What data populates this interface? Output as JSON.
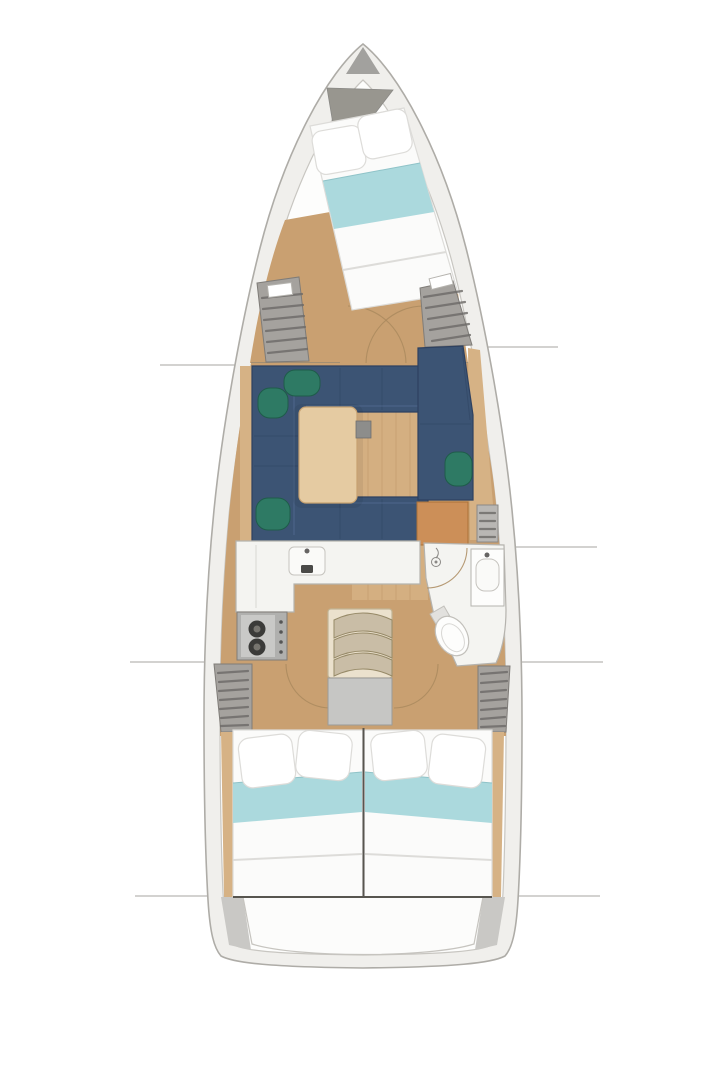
{
  "figure": {
    "type": "yacht-interior-floor-plan",
    "orientation": "bow-up",
    "description": "Top-down interior layout plan of a sailing yacht hull with no text labels"
  },
  "regions": [
    "bow-anchor-locker",
    "forward-cabin-v-berth",
    "forward-hanging-locker-port",
    "forward-hanging-locker-starboard",
    "salon-dinette-sofa",
    "salon-table",
    "starboard-settee",
    "nav-cabinet",
    "galley",
    "stove",
    "companionway-steps",
    "engine-box",
    "head-bathroom",
    "aft-hanging-locker-port",
    "aft-hanging-locker-starboard",
    "aft-cabin-port-bed",
    "aft-cabin-starboard-bed",
    "stern-transom"
  ],
  "colors": {
    "background": "#ffffff",
    "hullBand": "#f0efec",
    "hullLineOuter": "#aeaca7",
    "hullLineInner": "#c8c6c1",
    "interiorWhite": "#fdfdfc",
    "bowGray": "#a2a19e",
    "anchorGray": "#98968f",
    "wood": "#c9a071",
    "woodLight": "#ddbb8e",
    "woodTrim": "#d6b285",
    "plankLine": "#a87f50",
    "navy": "#3c5474",
    "navyDark": "#2e4160",
    "green": "#2e7a64",
    "greenDark": "#1f5c4a",
    "tableWood": "#e5cba2",
    "tableEdge": "#c7a271",
    "bracketGray": "#8d8d8b",
    "furnitureWhite": "#f4f4f1",
    "furnitureLine": "#b5b3ae",
    "metalGray": "#666463",
    "stoveGray": "#b0b0ae",
    "stovePanel": "#c9c9c7",
    "burnerDark": "#3b3b39",
    "orange": "#cc8f58",
    "orangeEdge": "#ad7237",
    "stepsCream": "#ebe1cd",
    "stepsFrameEdge": "#c2b595",
    "stepShade": "#c9bda6",
    "stepEdge": "#978a68",
    "engineGray": "#c6c6c4",
    "lockerGray": "#a5a29e",
    "lockerSlat": "#6b6966",
    "lockerEdge": "#7f7c78",
    "bedWhite": "#fbfbfa",
    "bedLine": "#dddcd9",
    "pillowWhite": "#ffffff",
    "aqua": "#abd9dd",
    "aquaEdge": "#8fc3c8",
    "sternGray": "#c9c8c5",
    "arcBrown": "#aa8a5e",
    "refLine": "#a7a5a1",
    "darkLine": "#57554f"
  }
}
